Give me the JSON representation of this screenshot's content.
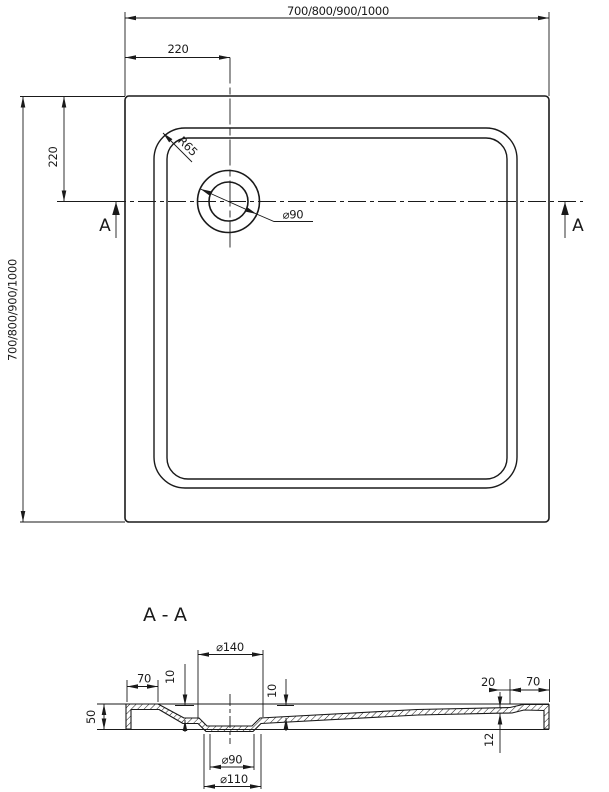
{
  "plan": {
    "overall_width_label": "700/800/900/1000",
    "overall_height_label": "700/800/900/1000",
    "drain_offset_x_label": "220",
    "drain_offset_y_label": "220",
    "corner_radius_label": "R65",
    "drain_diameter_label": "⌀90",
    "section_marker_left": "A",
    "section_marker_right": "A"
  },
  "section": {
    "title": "A-A",
    "flange_diameter_label": "⌀140",
    "rim_width_left_label": "70",
    "rim_drop_left_label": "10",
    "recess_drop_right_label": "10",
    "edge_height_label": "50",
    "step_width_label": "20",
    "rim_width_right_label": "70",
    "floor_thickness_label": "12",
    "drain_hole_label": "⌀90",
    "drain_recess_label": "⌀110"
  },
  "colors": {
    "line": "#1a1a1a",
    "background": "#ffffff"
  }
}
